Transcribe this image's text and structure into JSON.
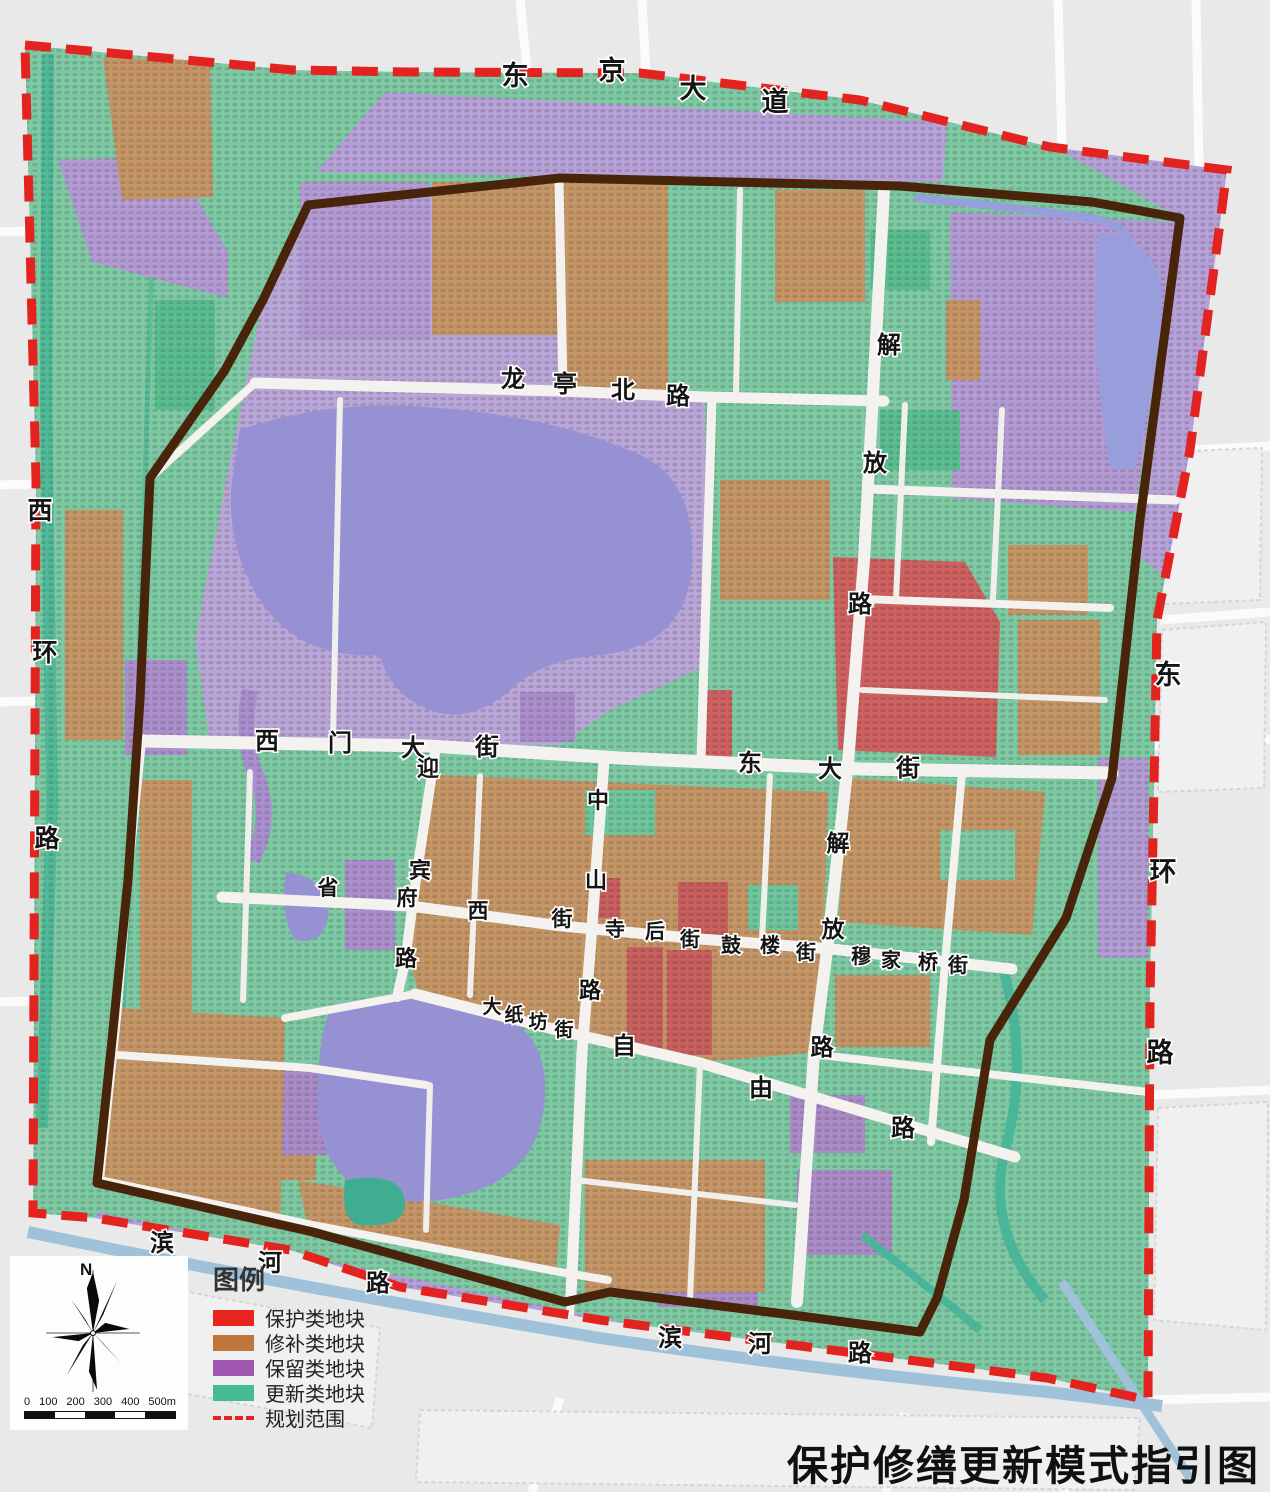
{
  "title": "保护修缮更新模式指引图",
  "legend": {
    "title": "图例",
    "items": [
      {
        "label": "保护类地块",
        "color": "#e8251f"
      },
      {
        "label": "修补类地块",
        "color": "#c0763b"
      },
      {
        "label": "保留类地块",
        "color": "#9f57b0"
      },
      {
        "label": "更新类地块",
        "color": "#45bb93"
      }
    ],
    "boundary": {
      "label": "规划范围",
      "color": "#e32320",
      "style": "dashed"
    }
  },
  "compass": {
    "north_label": "N"
  },
  "scale_bar": {
    "ticks": [
      "0",
      "100",
      "200",
      "300",
      "400",
      "500m"
    ]
  },
  "map": {
    "palette": {
      "protection_red": "#cd6060",
      "repair_brown": "#c49566",
      "retain_purple": "#b09bd2",
      "renewal_green": "#7cc9a3",
      "lake_blue": "#9691d3",
      "moat_blue": "#9fc2da",
      "city_wall_brown": "#48240a",
      "boundary_red": "#e32320",
      "road_white": "#f4f2ef",
      "outside_gray": "#e9e9e9"
    },
    "streets": [
      {
        "name": "东京大道",
        "size": 27,
        "chars": [
          {
            "t": "东",
            "x": 515,
            "y": 85
          },
          {
            "t": "京",
            "x": 612,
            "y": 80
          },
          {
            "t": "大",
            "x": 693,
            "y": 98
          },
          {
            "t": "道",
            "x": 775,
            "y": 111
          }
        ]
      },
      {
        "name": "西环路",
        "size": 25,
        "chars": [
          {
            "t": "西",
            "x": 40,
            "y": 519
          },
          {
            "t": "环",
            "x": 45,
            "y": 661
          },
          {
            "t": "路",
            "x": 47,
            "y": 847
          }
        ]
      },
      {
        "name": "东环路",
        "size": 27,
        "chars": [
          {
            "t": "东",
            "x": 1168,
            "y": 684
          },
          {
            "t": "环",
            "x": 1163,
            "y": 881
          },
          {
            "t": "路",
            "x": 1160,
            "y": 1062
          }
        ]
      },
      {
        "name": "龙亭北路",
        "size": 24,
        "chars": [
          {
            "t": "龙",
            "x": 513,
            "y": 387
          },
          {
            "t": "亭",
            "x": 565,
            "y": 392
          },
          {
            "t": "北",
            "x": 623,
            "y": 398
          },
          {
            "t": "路",
            "x": 678,
            "y": 404
          }
        ]
      },
      {
        "name": "解放路北段",
        "size": 24,
        "chars": [
          {
            "t": "解",
            "x": 889,
            "y": 353
          },
          {
            "t": "放",
            "x": 875,
            "y": 471
          },
          {
            "t": "路",
            "x": 860,
            "y": 612
          }
        ]
      },
      {
        "name": "解放路中段",
        "size": 23,
        "chars": [
          {
            "t": "解",
            "x": 838,
            "y": 851
          },
          {
            "t": "放",
            "x": 833,
            "y": 937
          },
          {
            "t": "路",
            "x": 822,
            "y": 1055
          }
        ]
      },
      {
        "name": "西门大街",
        "size": 24,
        "chars": [
          {
            "t": "西",
            "x": 267,
            "y": 749
          },
          {
            "t": "门",
            "x": 340,
            "y": 751
          },
          {
            "t": "大",
            "x": 413,
            "y": 756
          },
          {
            "t": "街",
            "x": 487,
            "y": 755
          }
        ]
      },
      {
        "name": "东大街",
        "size": 24,
        "chars": [
          {
            "t": "东",
            "x": 750,
            "y": 771
          },
          {
            "t": "大",
            "x": 830,
            "y": 777
          },
          {
            "t": "街",
            "x": 908,
            "y": 776
          }
        ]
      },
      {
        "name": "迎宾路",
        "size": 22,
        "chars": [
          {
            "t": "迎",
            "x": 428,
            "y": 776
          },
          {
            "t": "宾",
            "x": 420,
            "y": 878
          },
          {
            "t": "路",
            "x": 406,
            "y": 966
          }
        ]
      },
      {
        "name": "中山路",
        "size": 22,
        "chars": [
          {
            "t": "中",
            "x": 598,
            "y": 808
          },
          {
            "t": "山",
            "x": 596,
            "y": 888
          },
          {
            "t": "路",
            "x": 590,
            "y": 998
          }
        ]
      },
      {
        "name": "省府西街",
        "size": 21,
        "chars": [
          {
            "t": "省",
            "x": 328,
            "y": 895
          },
          {
            "t": "府",
            "x": 407,
            "y": 905
          },
          {
            "t": "西",
            "x": 478,
            "y": 918
          },
          {
            "t": "街",
            "x": 562,
            "y": 926
          }
        ]
      },
      {
        "name": "寺后街",
        "size": 20,
        "chars": [
          {
            "t": "寺",
            "x": 615,
            "y": 936
          },
          {
            "t": "后",
            "x": 655,
            "y": 938
          },
          {
            "t": "街",
            "x": 690,
            "y": 946
          }
        ]
      },
      {
        "name": "鼓楼街",
        "size": 20,
        "chars": [
          {
            "t": "鼓",
            "x": 731,
            "y": 952
          },
          {
            "t": "楼",
            "x": 770,
            "y": 952
          },
          {
            "t": "街",
            "x": 806,
            "y": 959
          }
        ]
      },
      {
        "name": "穆家桥街",
        "size": 20,
        "chars": [
          {
            "t": "穆",
            "x": 861,
            "y": 963
          },
          {
            "t": "家",
            "x": 891,
            "y": 967
          },
          {
            "t": "桥",
            "x": 928,
            "y": 969
          },
          {
            "t": "街",
            "x": 958,
            "y": 972
          }
        ]
      },
      {
        "name": "大纸坊街",
        "size": 19,
        "chars": [
          {
            "t": "大",
            "x": 492,
            "y": 1013
          },
          {
            "t": "纸",
            "x": 514,
            "y": 1021
          },
          {
            "t": "坊",
            "x": 538,
            "y": 1028
          },
          {
            "t": "街",
            "x": 564,
            "y": 1036
          }
        ]
      },
      {
        "name": "自由路",
        "size": 24,
        "chars": [
          {
            "t": "自",
            "x": 624,
            "y": 1054
          },
          {
            "t": "由",
            "x": 761,
            "y": 1096
          },
          {
            "t": "路",
            "x": 903,
            "y": 1136
          }
        ]
      },
      {
        "name": "滨河路西段",
        "size": 24,
        "chars": [
          {
            "t": "滨",
            "x": 162,
            "y": 1251
          },
          {
            "t": "河",
            "x": 270,
            "y": 1271
          },
          {
            "t": "路",
            "x": 378,
            "y": 1291
          }
        ]
      },
      {
        "name": "滨河路南段",
        "size": 24,
        "chars": [
          {
            "t": "滨",
            "x": 670,
            "y": 1346
          },
          {
            "t": "河",
            "x": 760,
            "y": 1352
          },
          {
            "t": "路",
            "x": 860,
            "y": 1361
          }
        ]
      }
    ]
  }
}
